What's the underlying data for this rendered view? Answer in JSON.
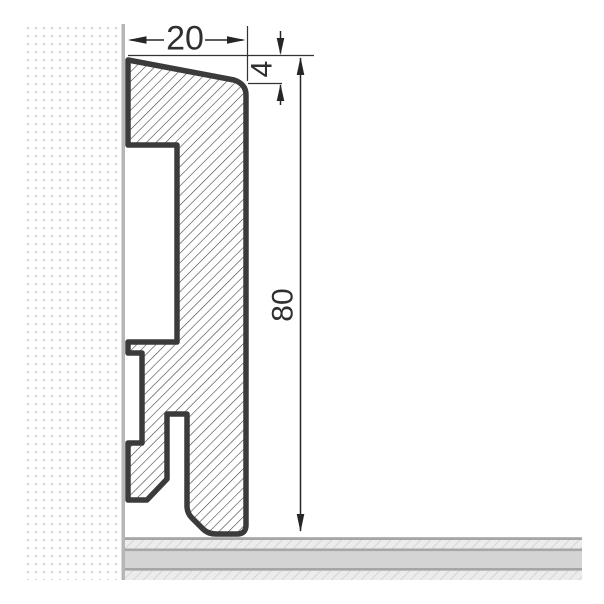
{
  "drawing": {
    "type": "technical cross-section drawing",
    "subject": "skirting-board profile mounted against a wall, standing on a floor",
    "dimension_labels": {
      "width": "20",
      "top_edge": "4",
      "height": "80"
    },
    "colors": {
      "background": "#ffffff",
      "profile_outline": "#3b3b3b",
      "profile_hatch_line": "#3c3c3c",
      "dimension_line": "#262626",
      "dimension_text": "#2f2f2f",
      "wall_dot": "#d4d4d4",
      "wall_edge": "#b6b6b6",
      "floor_border": "#a6a6a6",
      "floor_solid": "#d4d4d4",
      "floor_hatch_bg": "#ececec",
      "floor_hatch_line": "#c9c9c9"
    }
  }
}
